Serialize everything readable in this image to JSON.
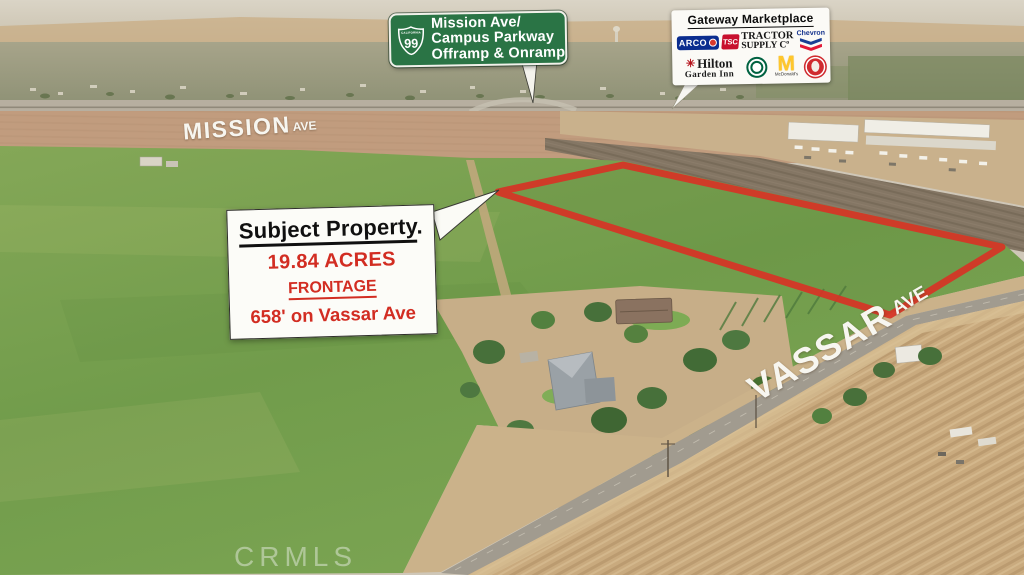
{
  "highway_sign": {
    "state_name": "CALIFORNIA",
    "route": "99",
    "lines": [
      "Mission Ave/",
      "Campus Parkway",
      "Offramp & Onramp"
    ],
    "background_color": "#2a7445",
    "text_color": "#ffffff"
  },
  "marketplace": {
    "title": "Gateway Marketplace",
    "logos": {
      "arco": {
        "label": "ARCO",
        "color": "#0b2d8f"
      },
      "tractor_supply": {
        "abbr": "TSC",
        "line1": "TRACTOR",
        "line2": "SUPPLY Cº",
        "color": "#c8102e"
      },
      "chevron": {
        "label": "Chevron",
        "blue": "#1a3f94",
        "red": "#e21836"
      },
      "hilton_garden_inn": {
        "line1": "Hilton",
        "line2": "Garden Inn",
        "mark": "✳",
        "mark_color": "#b5121b"
      },
      "starbucks": {
        "label": "Starbucks",
        "color": "#006241"
      },
      "mcdonalds": {
        "label": "McDonald's",
        "arch": "M",
        "color": "#ffc72c"
      },
      "panda_express": {
        "label": "Panda Express",
        "color": "#d02b2f"
      }
    }
  },
  "property_callout": {
    "title": "Subject Property",
    "period": ".",
    "acreage": "19.84 ACRES",
    "frontage_label": "FRONTAGE",
    "frontage_value": "658' on Vassar Ave",
    "accent_color": "#d22d22"
  },
  "parcel": {
    "outline_color": "#d63426"
  },
  "road_labels": {
    "mission": {
      "name": "MISSION",
      "suffix": "AVE"
    },
    "vassar": {
      "name": "VASSAR",
      "suffix": "AVE"
    }
  },
  "watermark": {
    "text": "CRMLS"
  }
}
